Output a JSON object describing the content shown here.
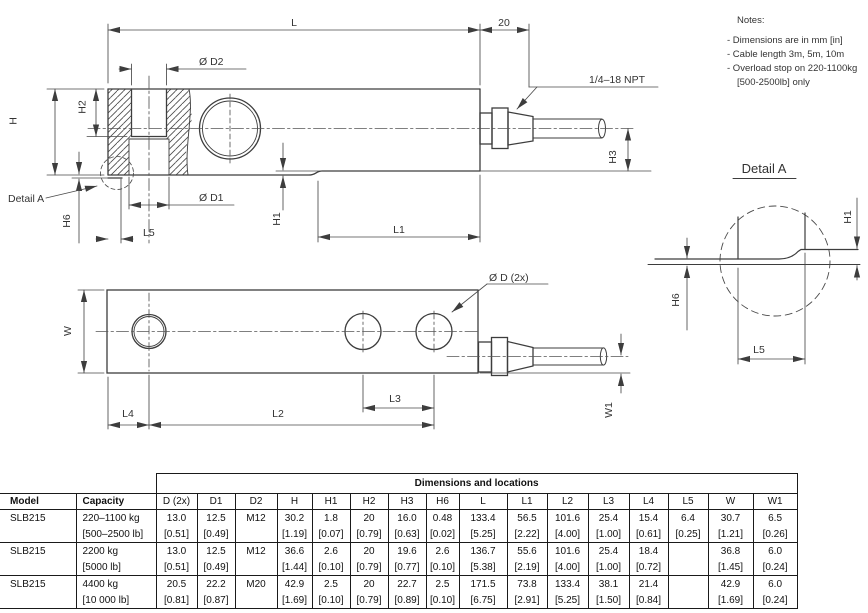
{
  "drawing": {
    "notes": {
      "title": "Notes:",
      "line1": "- Dimensions are in mm [in]",
      "line2": "- Cable length 3m, 5m, 10m",
      "line3": "- Overload stop on 220-1100kg",
      "line4": "[500-2500lb] only"
    },
    "side_view": {
      "dim_l": "L",
      "dim_20": "20",
      "dim_d2": "Ø D2",
      "npt": "1/4–18 NPT",
      "dim_h2": "H2",
      "dim_h": "H",
      "detail_ref": "Detail A",
      "dim_d1": "Ø D1",
      "dim_h6": "H6",
      "dim_l5": "L5",
      "dim_h1": "H1",
      "dim_l1": "L1",
      "dim_h3": "H3"
    },
    "top_view": {
      "dim_w": "W",
      "dim_d": "Ø D (2x)",
      "dim_l4": "L4",
      "dim_l2": "L2",
      "dim_l3": "L3",
      "dim_w1": "W1"
    },
    "detail_a": {
      "title": "Detail A",
      "dim_h1": "H1",
      "dim_h6": "H6",
      "dim_l5": "L5"
    }
  },
  "table": {
    "group_header": "Dimensions and locations",
    "headers": [
      "Model",
      "Capacity",
      "D (2x)",
      "D1",
      "D2",
      "H",
      "H1",
      "H2",
      "H3",
      "H6",
      "L",
      "L1",
      "L2",
      "L3",
      "L4",
      "L5",
      "W",
      "W1"
    ],
    "rows": [
      [
        "SLB215",
        "220–1100 kg",
        "13.0",
        "12.5",
        "M12",
        "30.2",
        "1.8",
        "20",
        "16.0",
        "0.48",
        "133.4",
        "56.5",
        "101.6",
        "25.4",
        "15.4",
        "6.4",
        "30.7",
        "6.5"
      ],
      [
        "",
        "[500–2500 lb]",
        "[0.51]",
        "[0.49]",
        "",
        "[1.19]",
        "[0.07]",
        "[0.79]",
        "[0.63]",
        "[0.02]",
        "[5.25]",
        "[2.22]",
        "[4.00]",
        "[1.00]",
        "[0.61]",
        "[0.25]",
        "[1.21]",
        "[0.26]"
      ],
      [
        "SLB215",
        "2200 kg",
        "13.0",
        "12.5",
        "M12",
        "36.6",
        "2.6",
        "20",
        "19.6",
        "2.6",
        "136.7",
        "55.6",
        "101.6",
        "25.4",
        "18.4",
        "",
        "36.8",
        "6.0"
      ],
      [
        "",
        "[5000 lb]",
        "[0.51]",
        "[0.49]",
        "",
        "[1.44]",
        "[0.10]",
        "[0.79]",
        "[0.77]",
        "[0.10]",
        "[5.38]",
        "[2.19]",
        "[4.00]",
        "[1.00]",
        "[0.72]",
        "",
        "[1.45]",
        "[0.24]"
      ],
      [
        "SLB215",
        "4400 kg",
        "20.5",
        "22.2",
        "M20",
        "42.9",
        "2.5",
        "20",
        "22.7",
        "2.5",
        "171.5",
        "73.8",
        "133.4",
        "38.1",
        "21.4",
        "",
        "42.9",
        "6.0"
      ],
      [
        "",
        "[10 000 lb]",
        "[0.81]",
        "[0.87]",
        "",
        "[1.69]",
        "[0.10]",
        "[0.79]",
        "[0.89]",
        "[0.10]",
        "[6.75]",
        "[2.91]",
        "[5.25]",
        "[1.50]",
        "[0.84]",
        "",
        "[1.69]",
        "[0.24]"
      ]
    ]
  }
}
